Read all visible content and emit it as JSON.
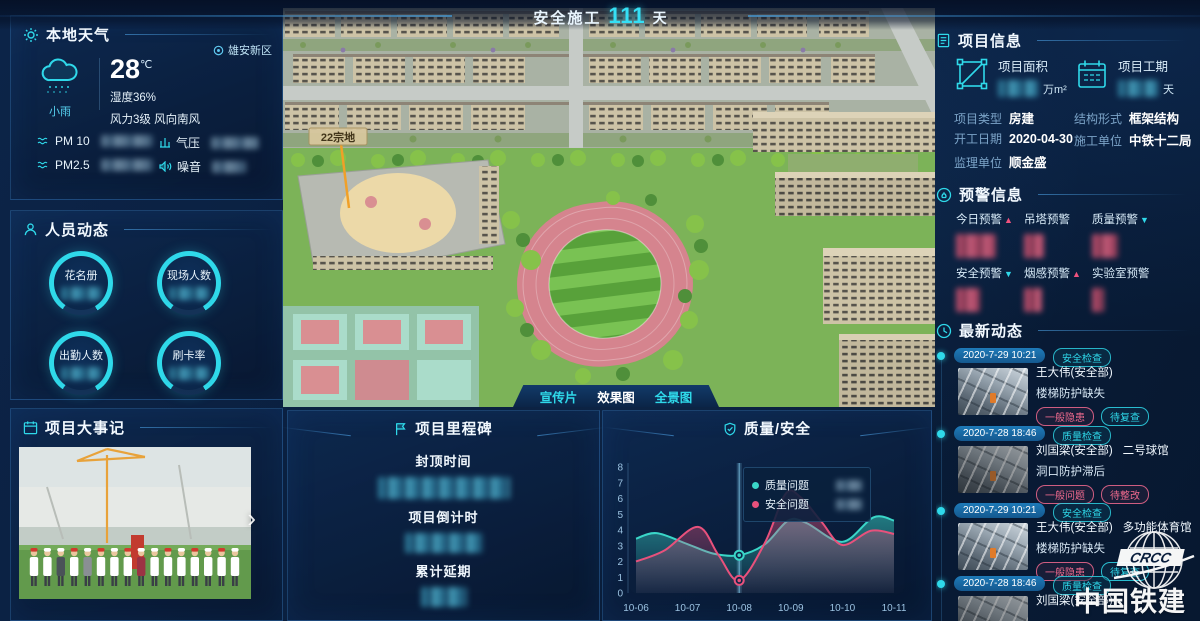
{
  "page": {
    "title": "安全施工",
    "days": "111",
    "unit": "天"
  },
  "colors": {
    "accent": "#2fd9ea",
    "pink": "#f0527e",
    "background": "#0a1f3e",
    "quality_series": "#3ad6c8",
    "safety_series": "#e8517c"
  },
  "weather": {
    "title": "本地天气",
    "location": "雄安新区",
    "temp": "28",
    "temp_unit": "℃",
    "condition": "小雨",
    "humidity": "湿度36%",
    "wind": "风力3级 风向南风",
    "metrics": [
      {
        "label": "PM 10"
      },
      {
        "label": "气压"
      },
      {
        "label": "PM2.5"
      },
      {
        "label": "噪音"
      }
    ]
  },
  "personnel": {
    "title": "人员动态",
    "gauges": [
      {
        "label": "花名册"
      },
      {
        "label": "现场人数"
      },
      {
        "label": "出勤人数"
      },
      {
        "label": "刷卡率"
      }
    ]
  },
  "events": {
    "title": "项目大事记",
    "next_label": "›"
  },
  "scene": {
    "plot_label": "22宗地",
    "view_buttons": [
      {
        "label": "宣传片",
        "active": false
      },
      {
        "label": "效果图",
        "active": true
      },
      {
        "label": "全景图",
        "active": false
      }
    ]
  },
  "milestones": {
    "title": "项目里程碑",
    "items": [
      {
        "label": "封顶时间"
      },
      {
        "label": "项目倒计时"
      },
      {
        "label": "累计延期"
      }
    ]
  },
  "project": {
    "title": "项目信息",
    "stats": [
      {
        "label": "项目面积",
        "unit": "万m²"
      },
      {
        "label": "项目工期",
        "unit": "天"
      }
    ],
    "fields": [
      {
        "label": "项目类型",
        "value": "房建"
      },
      {
        "label": "结构形式",
        "value": "框架结构"
      },
      {
        "label": "开工日期",
        "value": "2020-04-30"
      },
      {
        "label": "施工单位",
        "value": "中铁十二局"
      },
      {
        "label": "监理单位",
        "value": "顺金盛"
      }
    ]
  },
  "alerts": {
    "title": "预警信息",
    "items": [
      {
        "label": "今日预警",
        "arrow": "▲",
        "trend": "up"
      },
      {
        "label": "吊塔预警",
        "arrow": "",
        "trend": "none"
      },
      {
        "label": "质量预警",
        "arrow": "▼",
        "trend": "down"
      },
      {
        "label": "安全预警",
        "arrow": "▼",
        "trend": "down"
      },
      {
        "label": "烟感预警",
        "arrow": "▲",
        "trend": "up"
      },
      {
        "label": "实验室预警",
        "arrow": "",
        "trend": "none"
      }
    ]
  },
  "updates": {
    "title": "最新动态",
    "entries": [
      {
        "date": "2020-7-29 10:21",
        "type": "安全检查",
        "person": "王大伟(安全部)",
        "venue": "",
        "issue": "楼梯防护缺失",
        "tags": [
          {
            "text": "一般隐患",
            "tone": "pink"
          },
          {
            "text": "待复查",
            "tone": "cyan"
          }
        ]
      },
      {
        "date": "2020-7-28 18:46",
        "type": "质量检查",
        "person": "刘国梁(安全部)",
        "venue": "二号球馆",
        "issue": "洞口防护滞后",
        "tags": [
          {
            "text": "一般问题",
            "tone": "pink"
          },
          {
            "text": "待整改",
            "tone": "pink"
          }
        ]
      },
      {
        "date": "2020-7-29 10:21",
        "type": "安全检查",
        "person": "王大伟(安全部)",
        "venue": "多功能体育馆",
        "issue": "楼梯防护缺失",
        "tags": [
          {
            "text": "一般隐患",
            "tone": "pink"
          },
          {
            "text": "待复查",
            "tone": "cyan"
          }
        ]
      },
      {
        "date": "2020-7-28 18:46",
        "type": "质量检查",
        "person": "刘国梁(安全部)",
        "venue": "",
        "issue": "",
        "tags": []
      }
    ]
  },
  "logo": {
    "name": "中国铁建",
    "abbr": "CRCC"
  },
  "chart_data": {
    "type": "area",
    "title": "质量/安全",
    "x_ticks": [
      "10-06",
      "10-07",
      "10-08",
      "10-09",
      "10-10",
      "10-11"
    ],
    "ylim": [
      0,
      8
    ],
    "y_tick_interval": 1,
    "grid": false,
    "legend_position": "tooltip-at-highlight",
    "highlight_index": 2,
    "series": [
      {
        "name": "质量问题",
        "color": "#3ad6c8",
        "points": [
          [
            0,
            3.45
          ],
          [
            0.4,
            3.8
          ],
          [
            1,
            3.1
          ],
          [
            1.5,
            2.5
          ],
          [
            2,
            2.4
          ],
          [
            2.5,
            3.1
          ],
          [
            2.95,
            4.6
          ],
          [
            3.3,
            4.45
          ],
          [
            4,
            3.25
          ],
          [
            4.6,
            4.8
          ],
          [
            5,
            4.6
          ]
        ]
      },
      {
        "name": "安全问题",
        "color": "#e8517c",
        "points": [
          [
            0,
            2.0
          ],
          [
            0.55,
            2.7
          ],
          [
            1.2,
            4.2
          ],
          [
            1.6,
            2.4
          ],
          [
            2,
            0.8
          ],
          [
            2.5,
            3.2
          ],
          [
            2.9,
            6.3
          ],
          [
            3.2,
            6.05
          ],
          [
            3.6,
            4.5
          ],
          [
            4,
            3.05
          ],
          [
            4.55,
            3.95
          ],
          [
            5,
            3.75
          ]
        ]
      }
    ]
  }
}
